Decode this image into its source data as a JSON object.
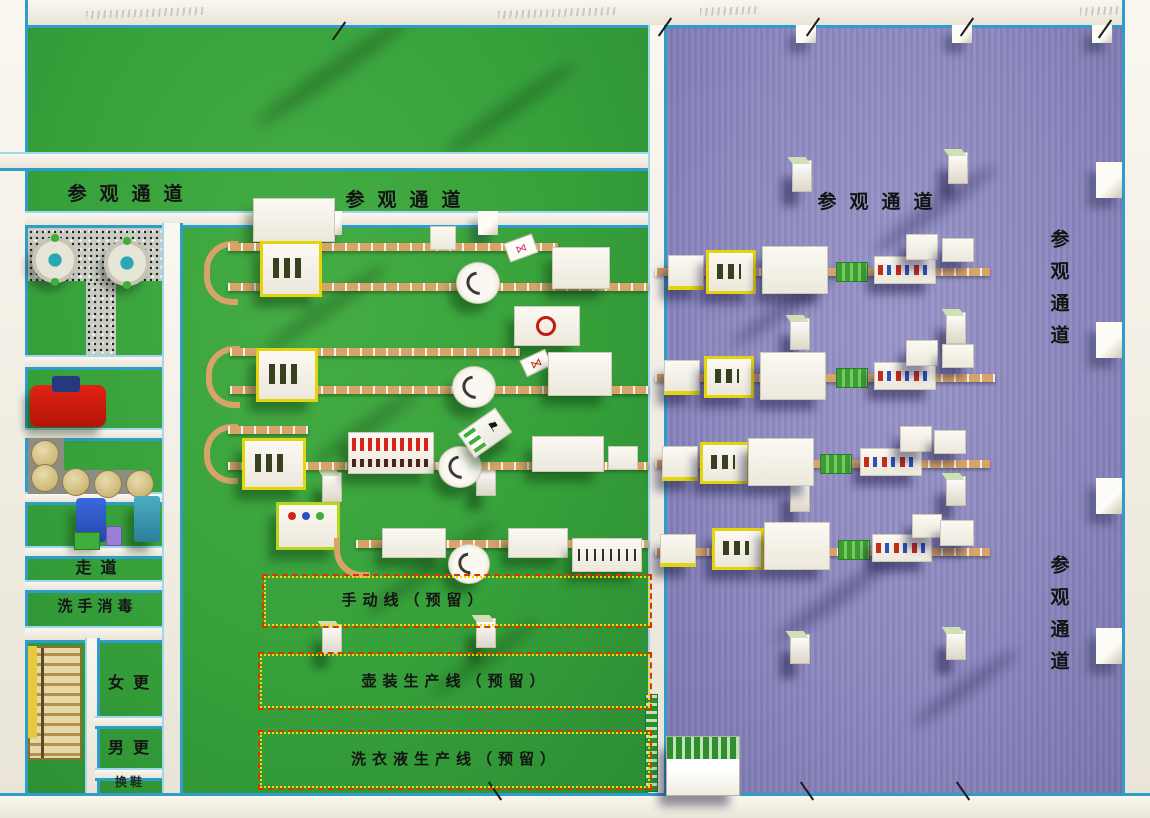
{
  "corridors": {
    "top_left": "参观通道",
    "top_mid": "参观通道",
    "top_right": "参观通道",
    "right_upper": "参观通道",
    "right_lower": "参观通道"
  },
  "rooms": {
    "walkway": "走道",
    "hand_wash": "洗手消毒",
    "women_changing": "女更",
    "men_changing": "男更",
    "shoe_change": "换鞋"
  },
  "reserved_lines": {
    "manual": "手动线（预留）",
    "jug": "壶装生产线（预留）",
    "laundry": "洗衣液生产线（预留）"
  },
  "icons": {
    "flag": "⚑",
    "bow_pink": "⋈",
    "bow_red": "⋈"
  },
  "colors": {
    "green_floor": "#36a03a",
    "purple_floor": "#8d89c0",
    "wall": "#f2eee5",
    "wall_trim_blue": "#2f9dc9",
    "conveyor_tan": "#d7a368",
    "machine_white": "#f6f4ee",
    "filler_yellow": "#e3d40c",
    "pallet_green": "#4db33e",
    "reserved_border_red": "#d23b00",
    "reserved_border_yellow": "#ffd400",
    "bottle_red": "#d42318",
    "tank_tan": "#d9c98f",
    "mixer_teal": "#2aa7b5",
    "red_machine": "#d41b12",
    "blue_machine": "#2f5fd0",
    "stairs_yellow": "#e7c93c"
  }
}
